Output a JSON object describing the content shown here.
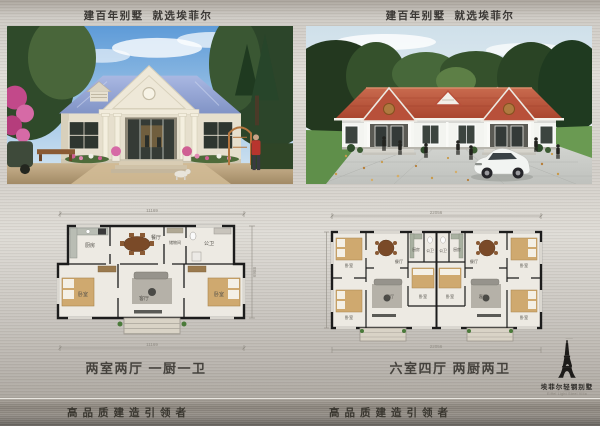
{
  "header": {
    "slogan_left": "建百年别墅  就选埃菲尔",
    "slogan_right": "建百年别墅  就选埃菲尔"
  },
  "captions": {
    "left": "两室两厅 一厨一卫",
    "right": "六室四厅 两厨两卫"
  },
  "footer": {
    "slogan_left": "高品质建造引领者",
    "slogan_right": "高品质建造引领者"
  },
  "logo": {
    "brand": "埃菲尔轻钢别墅",
    "brand_en": "Eiffel Light Steel Villa",
    "icon": "eiffel-tower-icon"
  },
  "left_plan": {
    "dim_top": "11169",
    "dim_bottom": "11169",
    "dim_right": "8869",
    "rooms": {
      "kitchen": "厨房",
      "dining": "餐厅",
      "storage": "储物间",
      "bath": "公卫",
      "bedroom_left": "卧室",
      "living": "客厅",
      "bedroom_right": "卧室"
    }
  },
  "right_plan": {
    "dim_top": "22056",
    "dim_bottom": "22056",
    "units": [
      {
        "bedroom_tl": "卧室",
        "dining": "餐厅",
        "kitchen": "厨房",
        "bath": "公卫",
        "bedroom_bl": "卧室",
        "living": "客厅",
        "bedroom_r": "卧室"
      },
      {
        "bedroom_tl": "卧室",
        "dining": "餐厅",
        "kitchen": "厨房",
        "bath": "公卫",
        "bedroom_bl": "卧室",
        "living": "客厅",
        "bedroom_r": "卧室"
      }
    ]
  },
  "colors": {
    "metal_light": "#e0ddd7",
    "metal_dark": "#6f6a64",
    "left_roof": "#93a6d6",
    "right_roof": "#b24a32",
    "text_dark": "#39362f",
    "plan_wall": "#1c1c1c",
    "bed_tan": "#cfa96f"
  }
}
